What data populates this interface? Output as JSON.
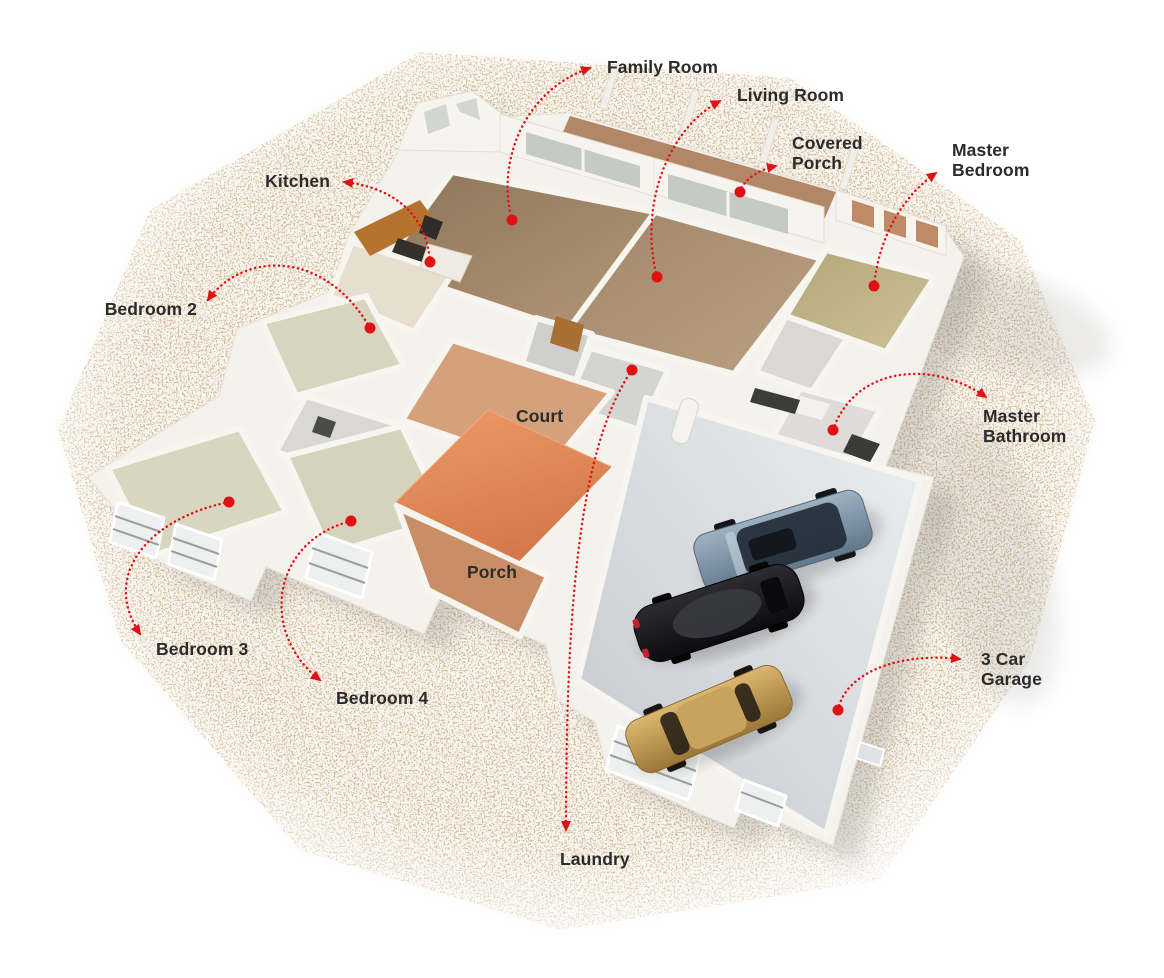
{
  "meta": {
    "description": "Isometric 3D doll-house style floor plan render with room annotations",
    "render_type": "3d-floor-plan"
  },
  "colors": {
    "background": "#ffffff",
    "label_text": "#2b2b2b",
    "leader_red": "#e01114",
    "wall_white": "#f4f2ec",
    "wood_floor": "#a98c6d",
    "carpet_floor": "#d8d5bf",
    "master_carpet": "#c0b388",
    "court_roof": "#e08a55",
    "porch_terracotta": "#c98e66",
    "garage_floor": "#dfe1e4",
    "gravel_speckle": "#b08a58",
    "car_suv": "#7e97a9",
    "car_sports": "#17171a",
    "car_sedan": "#c09a57"
  },
  "scene": {
    "garage_cars": [
      {
        "name": "suv-steel-blue",
        "color": "#7e97a9"
      },
      {
        "name": "sports-car-black",
        "color": "#17171a"
      },
      {
        "name": "sedan-gold",
        "color": "#c09a57"
      }
    ]
  },
  "annotations": [
    {
      "id": "family-room",
      "lines": [
        "Family Room"
      ],
      "x": 607,
      "y": 57,
      "align": "left",
      "dot": {
        "x": 512,
        "y": 220
      },
      "path": "M512,220 C496,162 524,90 590,68"
    },
    {
      "id": "living-room",
      "lines": [
        "Living Room"
      ],
      "x": 737,
      "y": 85,
      "align": "left",
      "dot": {
        "x": 657,
        "y": 277
      },
      "path": "M657,277 C639,208 666,130 720,101"
    },
    {
      "id": "covered-porch",
      "lines": [
        "Covered",
        "Porch"
      ],
      "x": 792,
      "y": 133,
      "align": "left",
      "dot": {
        "x": 740,
        "y": 192
      },
      "path": "M740,192 C743,181 757,170 776,166"
    },
    {
      "id": "master-bedroom",
      "lines": [
        "Master",
        "Bedroom"
      ],
      "x": 952,
      "y": 140,
      "align": "left",
      "dot": {
        "x": 874,
        "y": 286
      },
      "path": "M874,286 C879,236 903,196 936,173"
    },
    {
      "id": "kitchen",
      "lines": [
        "Kitchen"
      ],
      "x": 330,
      "y": 171,
      "align": "right",
      "dot": {
        "x": 430,
        "y": 262
      },
      "path": "M430,262 C427,218 398,188 344,182"
    },
    {
      "id": "bedroom-2",
      "lines": [
        "Bedroom 2"
      ],
      "x": 197,
      "y": 299,
      "align": "right",
      "dot": {
        "x": 370,
        "y": 328
      },
      "path": "M370,328 C324,248 242,252 208,300"
    },
    {
      "id": "court",
      "lines": [
        "Court"
      ],
      "x": 516,
      "y": 406,
      "align": "left",
      "dot": null,
      "path": null
    },
    {
      "id": "master-bathroom",
      "lines": [
        "Master",
        "Bathroom"
      ],
      "x": 983,
      "y": 406,
      "align": "left",
      "dot": {
        "x": 833,
        "y": 430
      },
      "path": "M833,430 C854,368 930,358 986,397"
    },
    {
      "id": "porch",
      "lines": [
        "Porch"
      ],
      "x": 467,
      "y": 562,
      "align": "left",
      "dot": null,
      "path": null
    },
    {
      "id": "bedroom-3",
      "lines": [
        "Bedroom 3"
      ],
      "x": 156,
      "y": 639,
      "align": "left",
      "dot": {
        "x": 229,
        "y": 502
      },
      "path": "M229,502 C150,518 100,574 140,634"
    },
    {
      "id": "bedroom-4",
      "lines": [
        "Bedroom 4"
      ],
      "x": 336,
      "y": 688,
      "align": "left",
      "dot": {
        "x": 351,
        "y": 521
      },
      "path": "M351,521 C270,542 260,634 320,680"
    },
    {
      "id": "three-car-garage",
      "lines": [
        "3 Car",
        "Garage"
      ],
      "x": 981,
      "y": 649,
      "align": "left",
      "dot": {
        "x": 838,
        "y": 710
      },
      "path": "M838,710 C845,674 896,652 960,659"
    },
    {
      "id": "laundry",
      "lines": [
        "Laundry"
      ],
      "x": 560,
      "y": 849,
      "align": "left",
      "dot": {
        "x": 632,
        "y": 370
      },
      "path": "M632,370 C580,446 566,600 566,830"
    }
  ]
}
